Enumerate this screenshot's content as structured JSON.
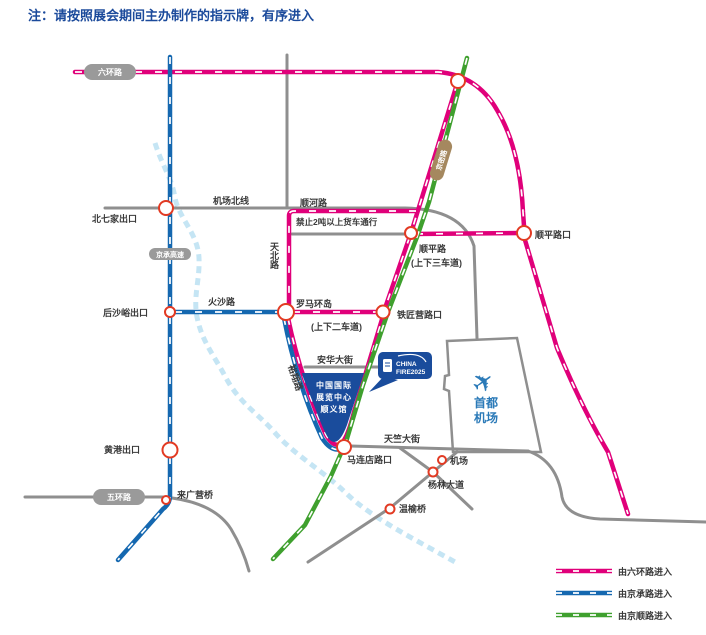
{
  "title": "注：请按照展会期间主办制作的指示牌，有序进入",
  "colors": {
    "route_pink": "#e0007a",
    "route_blue": "#1568b0",
    "route_green": "#3fa02e",
    "road_gray": "#8f8f8f",
    "river_blue": "#bfe2f3",
    "node_ring_red": "#e23a23",
    "venue_blue": "#1a4c9c",
    "airport_blue": "#2b7ab8",
    "title_blue": "#1b4a9b"
  },
  "pills": {
    "liuhuanlu": "六环路",
    "wuhuanlu": "五环路",
    "jingchenggaosu": "京承高速",
    "jingmilu": "京密路"
  },
  "roads": {
    "jichangbeixian": "机场北线",
    "shunhelu": "顺河路",
    "truck_ban": "禁止2吨以上货车通行",
    "tianbeilu": "天北路",
    "huoshalu": "火沙路",
    "shunpinglu": "顺平路",
    "shunping_lanes": "(上下三车道)",
    "luoma_lanes": "(上下二车道)",
    "anhua": "安华大街",
    "yuxianglu": "裕翔路",
    "tianzhu": "天竺大街"
  },
  "junctions": {
    "beiqijia": "北七家出口",
    "houshayu": "后沙峪出口",
    "luoma": "罗马环岛",
    "tiejiangying": "铁匠营路口",
    "shunpingkou": "顺平路口",
    "huanggang": "黄港出口",
    "laiguangying": "来广营桥",
    "maliandian": "马连店路口",
    "jichang": "机场",
    "yanglin": "杨林大道",
    "wenyu": "温榆桥"
  },
  "venue": {
    "line1": "中国国际",
    "line2": "展览中心",
    "line3": "顺义馆"
  },
  "logo": {
    "line1": "CHINA",
    "line2": "FIRE2025"
  },
  "airport": {
    "line1": "首都",
    "line2": "机场"
  },
  "legend": {
    "pink": "由六环路进入",
    "blue": "由京承路进入",
    "green": "由京顺路进入"
  }
}
